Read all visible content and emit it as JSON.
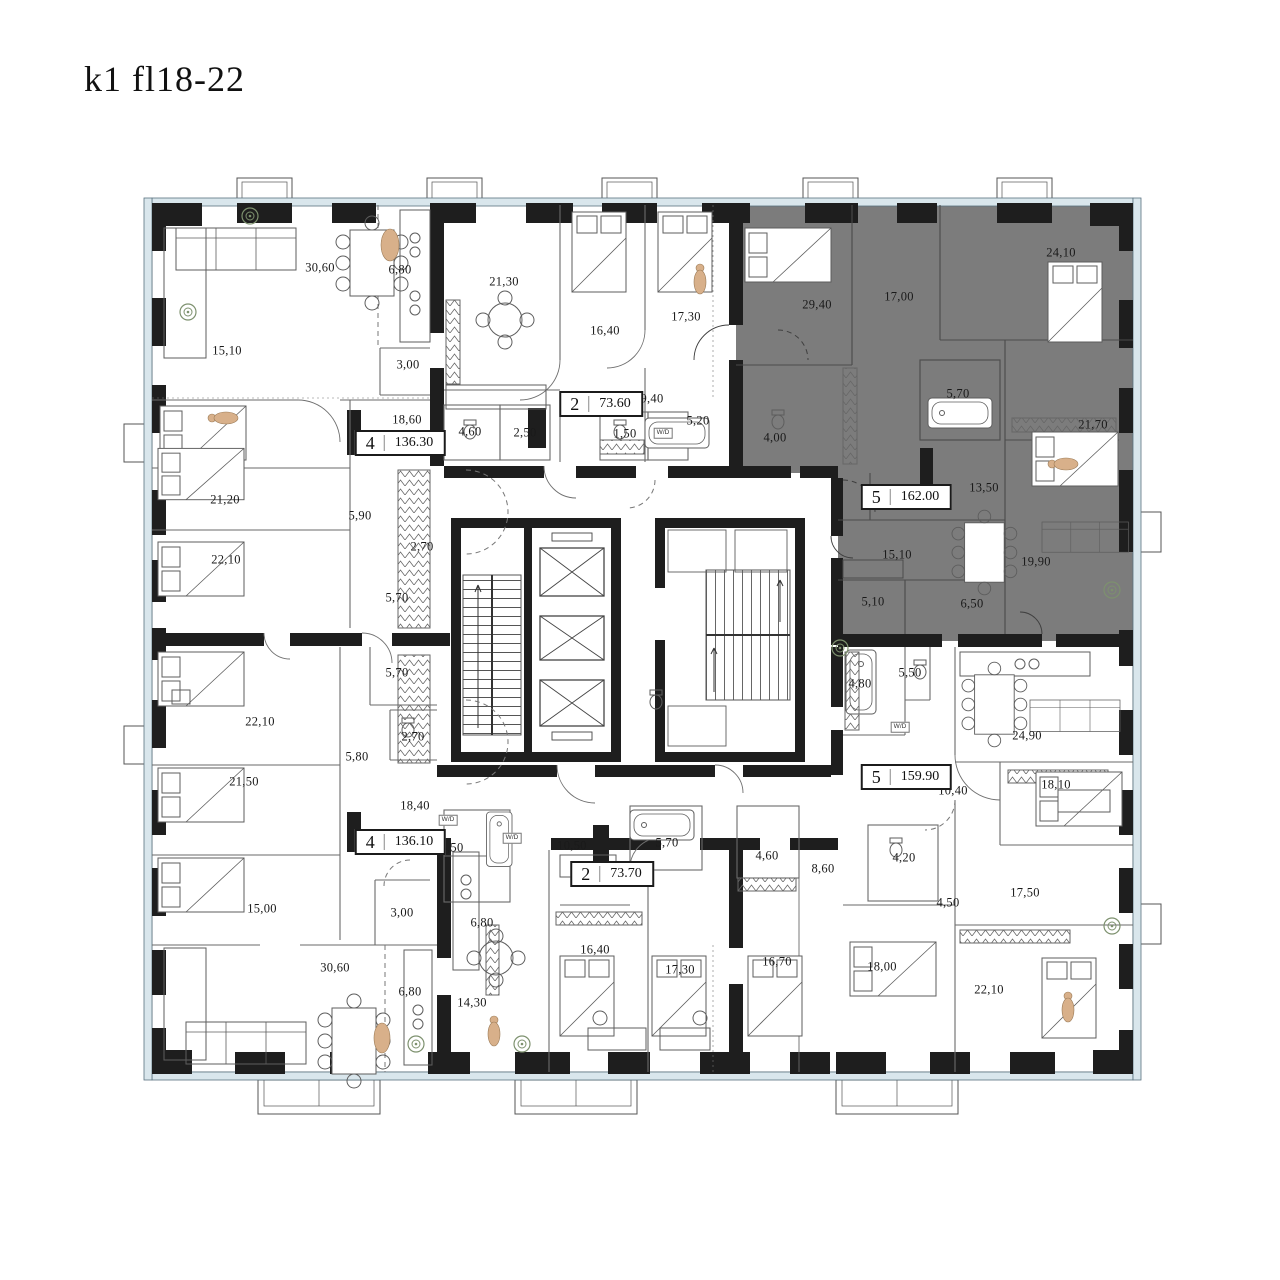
{
  "title": "k1 fl18-22",
  "colors": {
    "highlight_unit_fill": "#7c7c7c",
    "wall": "#1e1e1e",
    "glazing": "#d9e6ec",
    "accent_figure": "#d8b08a",
    "plant": "#7d916e"
  },
  "units": [
    {
      "rooms": "4",
      "area": "136.30",
      "x": 400,
      "y": 443,
      "highlighted": false
    },
    {
      "rooms": "2",
      "area": "73.60",
      "x": 601,
      "y": 404,
      "highlighted": false
    },
    {
      "rooms": "5",
      "area": "162.00",
      "x": 906,
      "y": 497,
      "highlighted": true
    },
    {
      "rooms": "5",
      "area": "159.90",
      "x": 906,
      "y": 777,
      "highlighted": false
    },
    {
      "rooms": "4",
      "area": "136.10",
      "x": 400,
      "y": 842,
      "highlighted": false
    },
    {
      "rooms": "2",
      "area": "73.70",
      "x": 612,
      "y": 874,
      "highlighted": false
    }
  ],
  "room_labels": [
    {
      "t": "30,60",
      "x": 320,
      "y": 268
    },
    {
      "t": "6,80",
      "x": 400,
      "y": 270
    },
    {
      "t": "15,10",
      "x": 227,
      "y": 351
    },
    {
      "t": "3,00",
      "x": 408,
      "y": 365
    },
    {
      "t": "18,60",
      "x": 407,
      "y": 420
    },
    {
      "t": "4,60",
      "x": 470,
      "y": 432
    },
    {
      "t": "2,50",
      "x": 525,
      "y": 433
    },
    {
      "t": "21,20",
      "x": 225,
      "y": 500
    },
    {
      "t": "5,90",
      "x": 360,
      "y": 516
    },
    {
      "t": "2,70",
      "x": 422,
      "y": 547
    },
    {
      "t": "22,10",
      "x": 226,
      "y": 560
    },
    {
      "t": "5,70",
      "x": 397,
      "y": 598
    },
    {
      "t": "21,30",
      "x": 504,
      "y": 282
    },
    {
      "t": "16,40",
      "x": 605,
      "y": 331
    },
    {
      "t": "17,30",
      "x": 686,
      "y": 317
    },
    {
      "t": "9,40",
      "x": 652,
      "y": 399
    },
    {
      "t": "5,20",
      "x": 698,
      "y": 421
    },
    {
      "t": "1,50",
      "x": 625,
      "y": 434
    },
    {
      "t": "24,10",
      "x": 1061,
      "y": 253
    },
    {
      "t": "17,00",
      "x": 899,
      "y": 297
    },
    {
      "t": "29,40",
      "x": 817,
      "y": 305
    },
    {
      "t": "5,70",
      "x": 958,
      "y": 394
    },
    {
      "t": "21,70",
      "x": 1093,
      "y": 425
    },
    {
      "t": "4,00",
      "x": 775,
      "y": 438
    },
    {
      "t": "13,50",
      "x": 984,
      "y": 488
    },
    {
      "t": "15,10",
      "x": 897,
      "y": 555
    },
    {
      "t": "19,90",
      "x": 1036,
      "y": 562
    },
    {
      "t": "5,10",
      "x": 873,
      "y": 602
    },
    {
      "t": "6,50",
      "x": 972,
      "y": 604
    },
    {
      "t": "5,70",
      "x": 397,
      "y": 673
    },
    {
      "t": "22,10",
      "x": 260,
      "y": 722
    },
    {
      "t": "2,70",
      "x": 413,
      "y": 737
    },
    {
      "t": "5,80",
      "x": 357,
      "y": 757
    },
    {
      "t": "21,50",
      "x": 244,
      "y": 782
    },
    {
      "t": "18,40",
      "x": 415,
      "y": 806
    },
    {
      "t": "4,50",
      "x": 452,
      "y": 848
    },
    {
      "t": "15,00",
      "x": 262,
      "y": 909
    },
    {
      "t": "3,00",
      "x": 402,
      "y": 913
    },
    {
      "t": "30,60",
      "x": 335,
      "y": 968
    },
    {
      "t": "6,80",
      "x": 410,
      "y": 992
    },
    {
      "t": "6,80",
      "x": 482,
      "y": 923
    },
    {
      "t": "14,30",
      "x": 472,
      "y": 1003
    },
    {
      "t": "10,50",
      "x": 572,
      "y": 846
    },
    {
      "t": "5,70",
      "x": 667,
      "y": 843
    },
    {
      "t": "4,60",
      "x": 767,
      "y": 856
    },
    {
      "t": "8,60",
      "x": 823,
      "y": 869
    },
    {
      "t": "16,40",
      "x": 595,
      "y": 950
    },
    {
      "t": "17,30",
      "x": 680,
      "y": 970
    },
    {
      "t": "16,70",
      "x": 777,
      "y": 962
    },
    {
      "t": "5,50",
      "x": 910,
      "y": 673
    },
    {
      "t": "4,80",
      "x": 860,
      "y": 684
    },
    {
      "t": "24,90",
      "x": 1027,
      "y": 736
    },
    {
      "t": "18,10",
      "x": 1056,
      "y": 785
    },
    {
      "t": "10,40",
      "x": 953,
      "y": 791
    },
    {
      "t": "4,20",
      "x": 904,
      "y": 858
    },
    {
      "t": "17,50",
      "x": 1025,
      "y": 893
    },
    {
      "t": "4,50",
      "x": 948,
      "y": 903
    },
    {
      "t": "18,00",
      "x": 882,
      "y": 967
    },
    {
      "t": "22,10",
      "x": 989,
      "y": 990
    }
  ],
  "wd_labels": [
    {
      "t": "W/D",
      "x": 663,
      "y": 433
    },
    {
      "t": "W/D",
      "x": 900,
      "y": 727
    },
    {
      "t": "W/D",
      "x": 448,
      "y": 820
    },
    {
      "t": "W/D",
      "x": 512,
      "y": 838
    }
  ]
}
